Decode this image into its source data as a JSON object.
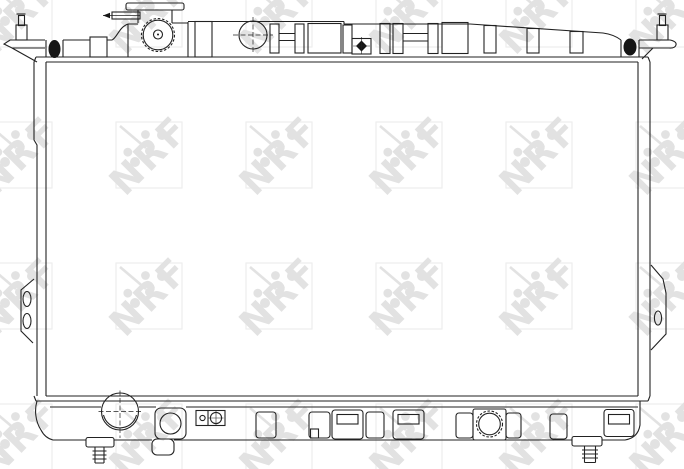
{
  "figure": {
    "type": "technical line drawing",
    "subject": "Automotive radiator, front view"
  },
  "watermark": {
    "text": "NRF",
    "letter_color": "#e2e2e2",
    "square_color": "#ededed"
  },
  "colors": {
    "background": "#ffffff",
    "line": "#222222",
    "solid_details": "#161616"
  }
}
